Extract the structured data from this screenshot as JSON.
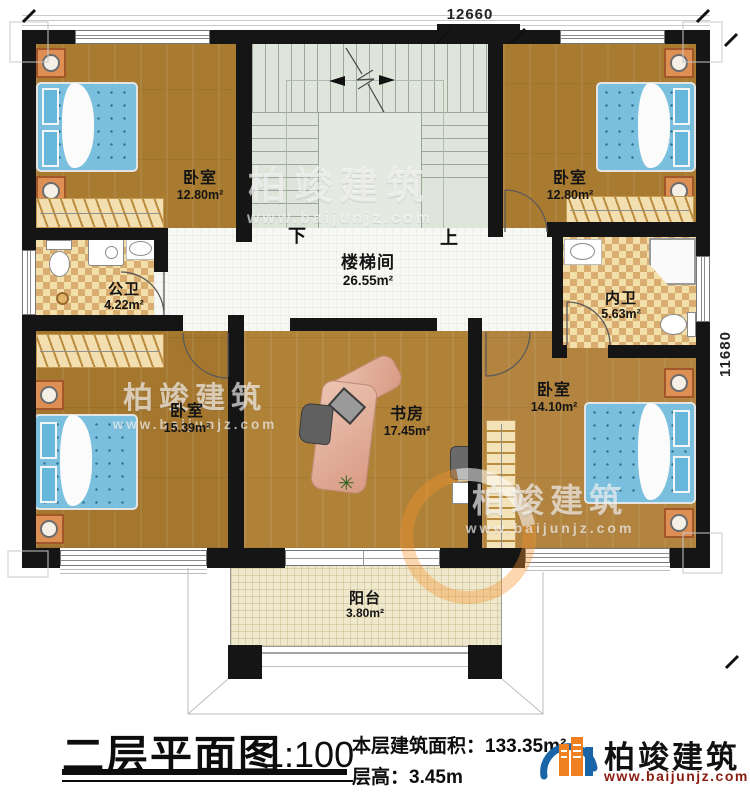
{
  "plan": {
    "dimensions": {
      "width_label": "12660",
      "height_label": "11680"
    },
    "rooms": [
      {
        "name": "卧室",
        "area": "12.80m²"
      },
      {
        "name": "卧室",
        "area": "12.80m²"
      },
      {
        "name": "楼梯间",
        "area": "26.55m²"
      },
      {
        "name": "公卫",
        "area": "4.22m²"
      },
      {
        "name": "内卫",
        "area": "5.63m²"
      },
      {
        "name": "卧室",
        "area": "15.39m²"
      },
      {
        "name": "书房",
        "area": "17.45m²"
      },
      {
        "name": "卧室",
        "area": "14.10m²"
      },
      {
        "name": "阳台",
        "area": "3.80m²"
      }
    ],
    "stair_labels": {
      "down": "下",
      "up": "上"
    }
  },
  "title_block": {
    "title": "二层平面图",
    "scale": "1:100",
    "floor_area_label": "本层建筑面积：",
    "floor_area_value": "133.35m²",
    "floor_height_label": "层高：",
    "floor_height_value": "3.45m"
  },
  "brand": {
    "name": "柏竣建筑",
    "website": "www.baijunjz.com"
  },
  "watermark": {
    "name": "柏竣建筑",
    "website": "www.baijunjz.com"
  },
  "colors": {
    "wall": "#151515",
    "wood": "#aa7c33",
    "tile_light": "#f3dfa9",
    "tile_dark": "#d9ad6f",
    "stair_floor": "#dfe5db",
    "bed_blue": "#7ac0de",
    "brand_blue": "#1a64a8",
    "brand_orange": "#ef8021",
    "website_red": "#8b1c12"
  }
}
